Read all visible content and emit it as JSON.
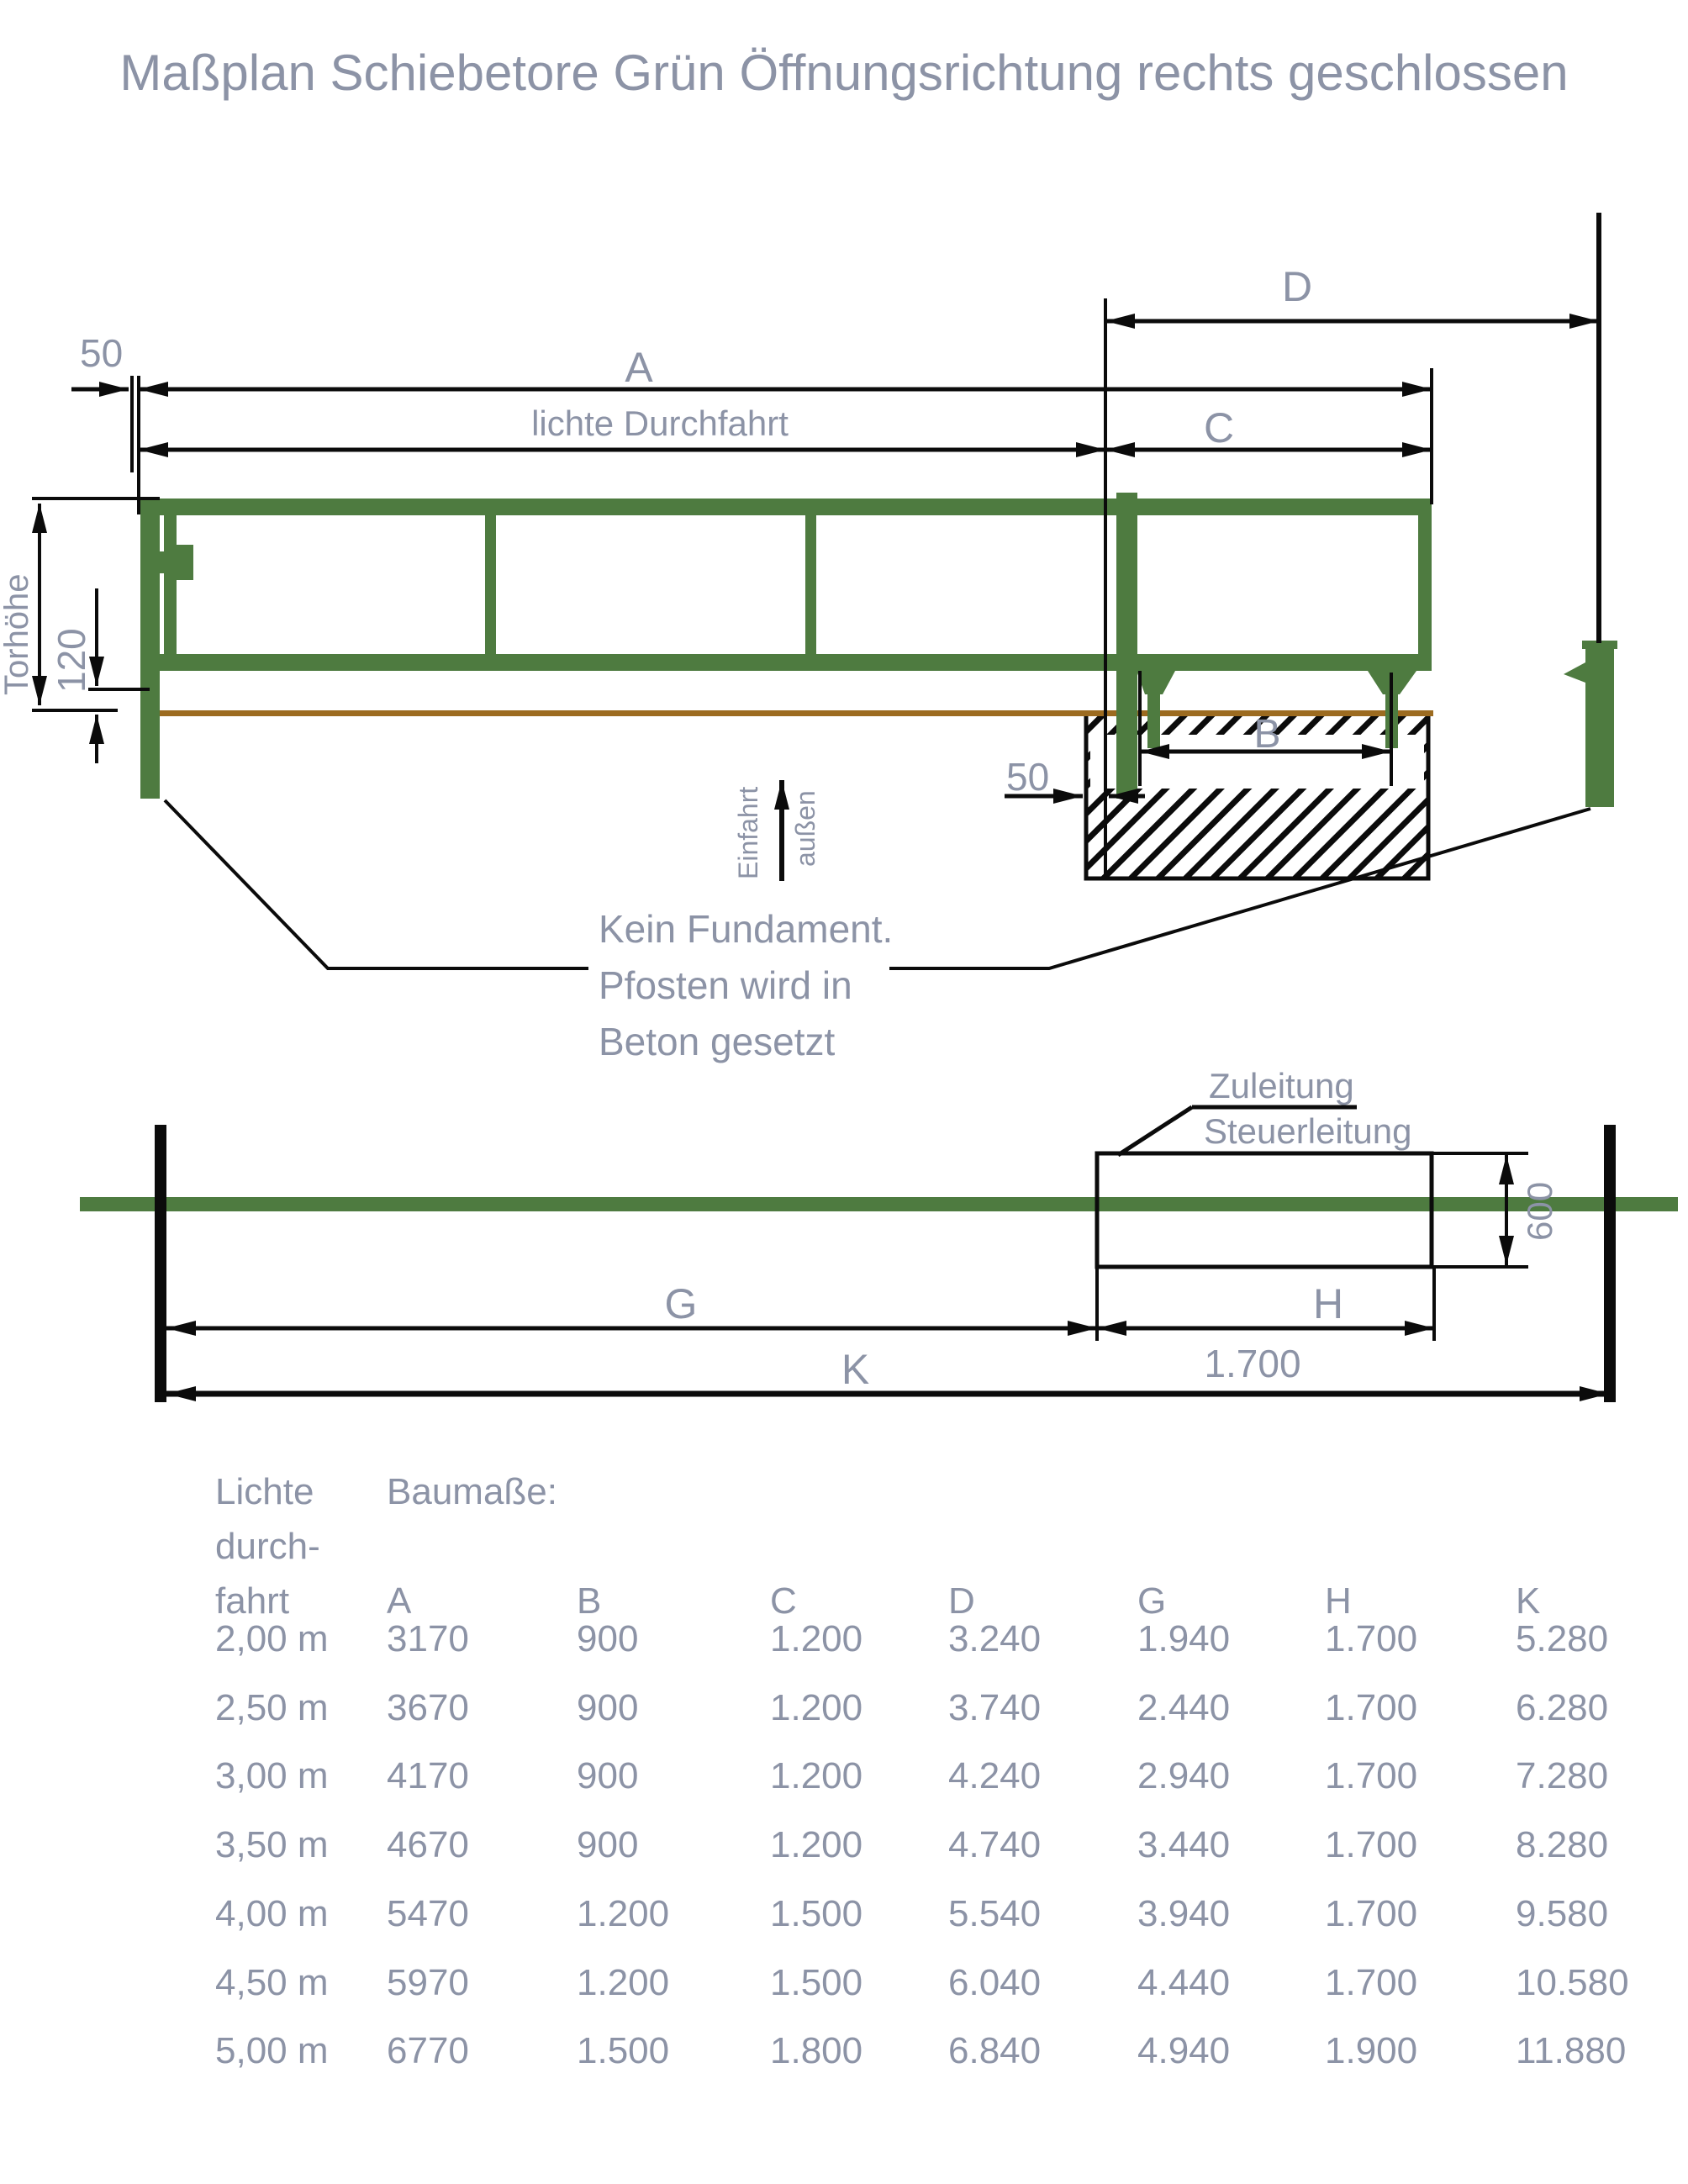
{
  "title": "Maßplan Schiebetore Grün Öffnungsrichtung rechts geschlossen",
  "colors": {
    "green": "#4e7b40",
    "brown": "#9c6b20",
    "label_gray": "#8c93a6",
    "line_black": "#0b0b0b"
  },
  "front_view": {
    "dim_50_left": "50",
    "dim_a": "A",
    "dim_lichte_durchfahrt": "lichte Durchfahrt",
    "dim_c": "C",
    "dim_d": "D",
    "dim_b": "B",
    "dim_50_foundation": "50",
    "dim_torhoehe": "Torhöhe",
    "dim_120": "120",
    "arrow_label_left": "Einfahrt",
    "arrow_label_right": "außen",
    "note_line1": "Kein Fundament.",
    "note_line2": "Pfosten wird in",
    "note_line3": "Beton gesetzt"
  },
  "top_view": {
    "label_zuleitung": "Zuleitung",
    "label_steuerleitung": "Steuerleitung",
    "dim_600": "600",
    "dim_g": "G",
    "dim_h": "H",
    "dim_1700": "1.700",
    "dim_k": "K"
  },
  "table": {
    "col1_header_lines": [
      "Lichte",
      "durch-",
      "fahrt"
    ],
    "col2_header": "Baumaße:",
    "columns": [
      "A",
      "B",
      "C",
      "D",
      "G",
      "H",
      "K"
    ],
    "rows": [
      {
        "durchfahrt": "2,00 m",
        "values": [
          "3170",
          "900",
          "1.200",
          "3.240",
          "1.940",
          "1.700",
          "5.280"
        ]
      },
      {
        "durchfahrt": "2,50 m",
        "values": [
          "3670",
          "900",
          "1.200",
          "3.740",
          "2.440",
          "1.700",
          "6.280"
        ]
      },
      {
        "durchfahrt": "3,00 m",
        "values": [
          "4170",
          "900",
          "1.200",
          "4.240",
          "2.940",
          "1.700",
          "7.280"
        ]
      },
      {
        "durchfahrt": "3,50 m",
        "values": [
          "4670",
          "900",
          "1.200",
          "4.740",
          "3.440",
          "1.700",
          "8.280"
        ]
      },
      {
        "durchfahrt": "4,00 m",
        "values": [
          "5470",
          "1.200",
          "1.500",
          "5.540",
          "3.940",
          "1.700",
          "9.580"
        ]
      },
      {
        "durchfahrt": "4,50 m",
        "values": [
          "5970",
          "1.200",
          "1.500",
          "6.040",
          "4.440",
          "1.700",
          "10.580"
        ]
      },
      {
        "durchfahrt": "5,00 m",
        "values": [
          "6770",
          "1.500",
          "1.800",
          "6.840",
          "4.940",
          "1.900",
          "11.880"
        ]
      }
    ]
  }
}
